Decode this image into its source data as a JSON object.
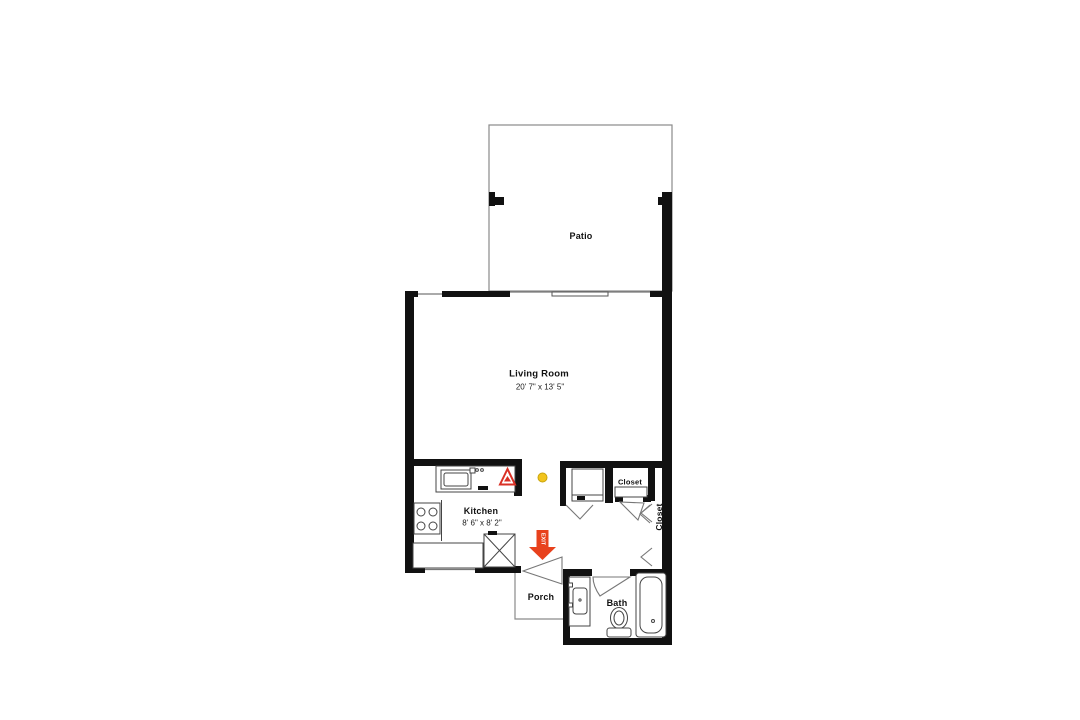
{
  "floor_plan": {
    "rooms": {
      "patio": {
        "label": "Patio"
      },
      "living_room": {
        "label": "Living Room",
        "dimensions": "20' 7\" x 13' 5\""
      },
      "kitchen": {
        "label": "Kitchen",
        "dimensions": "8' 6\" x 8' 2\""
      },
      "small_closet": {
        "label": "Closet"
      },
      "tall_closet": {
        "label": "Closet"
      },
      "porch": {
        "label": "Porch"
      },
      "bath": {
        "label": "Bath"
      }
    },
    "annotations": {
      "exit_arrow": {
        "label": "EXIT",
        "color": "#e8411c"
      },
      "smoke_detector": {
        "color": "#f2c41d"
      },
      "warning_triangle": {
        "color": "#d93025"
      }
    },
    "wall_color": "#111111",
    "outline_color": "#8a8a8a"
  }
}
